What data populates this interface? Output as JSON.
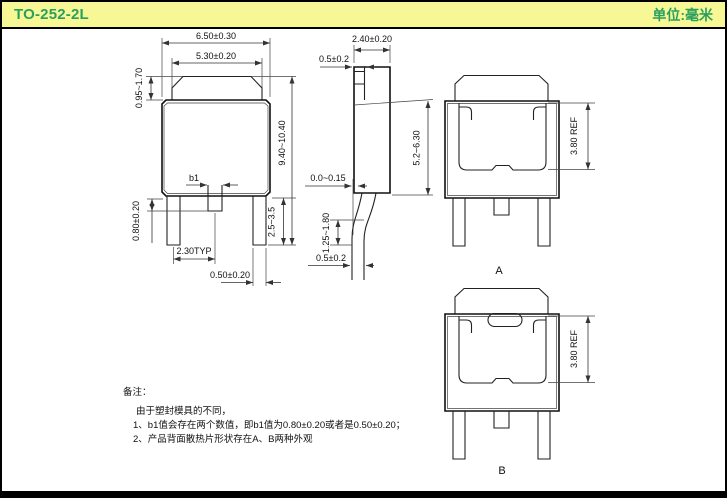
{
  "header": {
    "title": "TO-252-2L",
    "unit_label": "单位:毫米"
  },
  "colors": {
    "header_bg": "#f7f796",
    "header_text": "#2aa05f",
    "line": "#222222"
  },
  "front_view": {
    "top_width": "6.50±0.30",
    "cap_width": "5.30±0.20",
    "cap_height": "0.95~1.70",
    "overall_height": "9.40~10.40",
    "b1_label": "b1",
    "center_lead_length": "0.80±0.20",
    "lead_pitch": "2.30TYP",
    "lead_width": "0.50±0.20",
    "lead_length": "2.5~3.5"
  },
  "side_view": {
    "body_thickness": "2.40±0.20",
    "tab_thickness": "0.5±0.2",
    "body_height": "5.2~6.30",
    "standoff": "0.0~0.15",
    "bend_height": "1.25~1.80",
    "lead_thickness": "0.5±0.2"
  },
  "back_views": {
    "a": {
      "label": "A",
      "pad_ref": "3.80 REF"
    },
    "b": {
      "label": "B",
      "pad_ref": "3.80 REF"
    }
  },
  "notes": {
    "heading": "备注：",
    "intro": "由于塑封模具的不同，",
    "items": [
      "1、b1值会存在两个数值，即b1值为0.80±0.20或者是0.50±0.20；",
      "2、产品背面散热片形状存在A、B两种外观"
    ]
  }
}
